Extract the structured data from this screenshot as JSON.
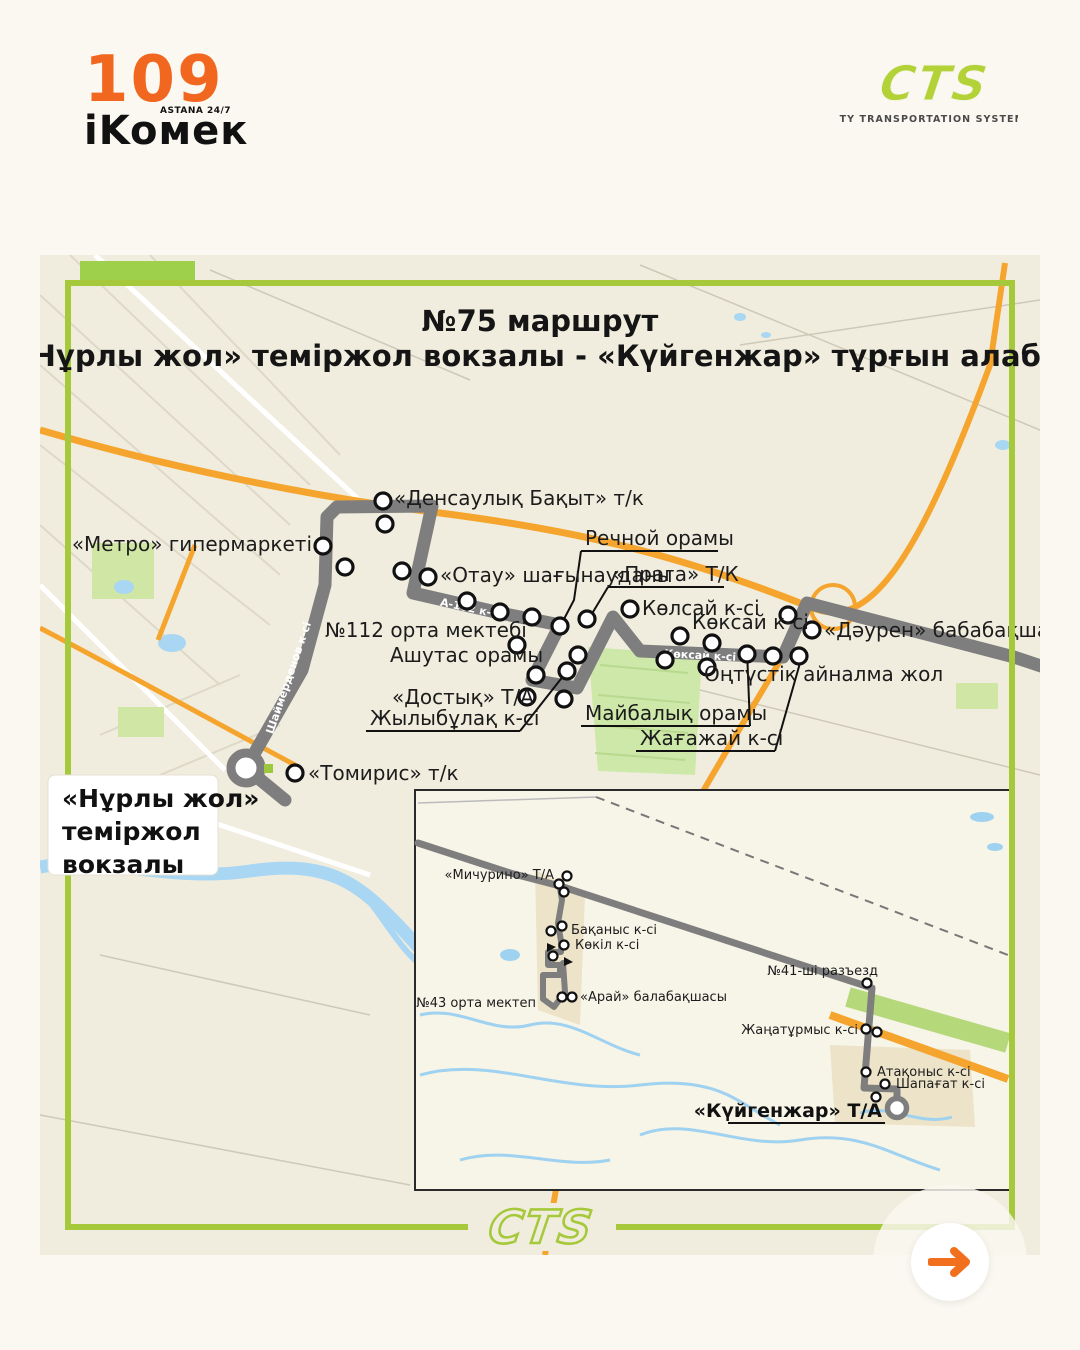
{
  "header": {
    "ikomek": {
      "number": "109",
      "brand": "iKoмек",
      "tagline": "ASTANA 24/7"
    },
    "cts": {
      "abbr": "CTS",
      "subtitle": "CITY TRANSPORTATION SYSTEMS"
    }
  },
  "map": {
    "title1": "№75 маршрут",
    "title2": "«Нұрлы жол» теміржол вокзалы - «Күйгенжар» тұрғын алабы",
    "terminal_box": {
      "line1": "«Нұрлы жол»",
      "line2": "теміржол",
      "line3": "вокзалы"
    },
    "streets": [
      "Шаймерденов к-сі",
      "А-102 к-сі",
      "Көксай к-сі"
    ],
    "stops": [
      "«Денсаулық Бақыт» т/к",
      "«Метро» гипермаркеті",
      "«Отау» шағынауданы",
      "Речной орамы",
      "«Прага» Т/К",
      "Көлсай к-сі",
      "Көксай к-сі",
      "«Дәурен» бабабақшасы",
      "№112 орта мектебі",
      "Ашутас орамы",
      "«Достық» Т/А",
      "Жылыбұлақ к-сі",
      "Майбалық орамы",
      "Жағажай к-сі",
      "Оңтүстік айналма жол",
      "«Томирис» т/к"
    ],
    "inset": {
      "stops": [
        "«Мичурино» Т/А",
        "Бақаныс к-сі",
        "Көкіл к-сі",
        "«Арай» балабақшасы",
        "№43 орта мектеп",
        "№41-ші разъезд",
        "Жаңатұрмыс к-сі",
        "Атақоныс к-сі",
        "Шапағат к-сі",
        "«Күйгенжар» Т/А"
      ]
    }
  },
  "footer": {
    "watermark": "CTS"
  },
  "colors": {
    "accent_orange": "#F2671F",
    "arrow_orange": "#F26F1D",
    "lime_border": "#A5C93B",
    "cts_lime": "#B3D238",
    "route_gray": "#7E7E7E",
    "highway_orange": "#F5A52E",
    "water_blue": "#A9D7F3",
    "park_green": "#CDE8A8",
    "map_bg": "#F1EDDE"
  }
}
